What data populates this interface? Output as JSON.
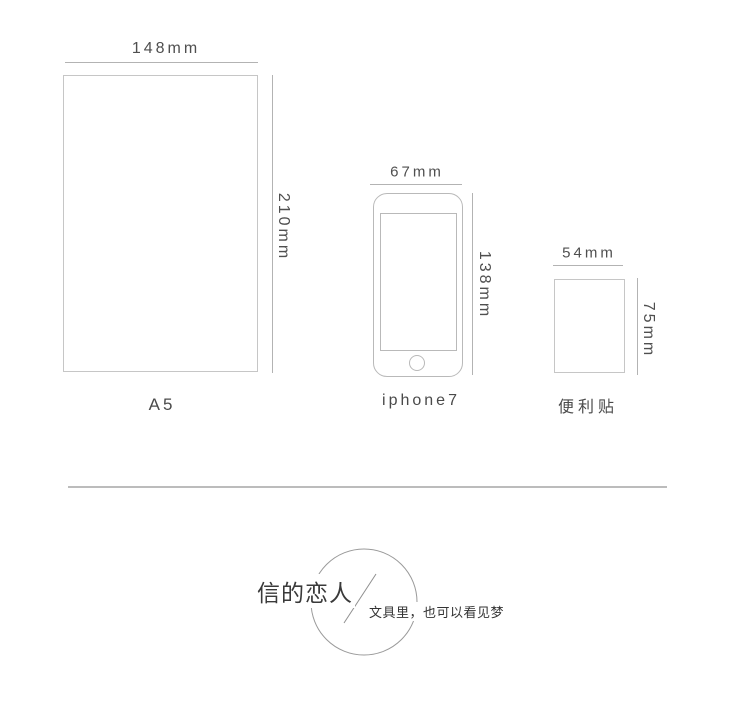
{
  "comparison": {
    "items": [
      {
        "name": "A5 paper",
        "label": "A5",
        "width": "148mm",
        "height": "210mm"
      },
      {
        "name": "iPhone 7",
        "label": "iphone7",
        "width": "67mm",
        "height": "138mm"
      },
      {
        "name": "sticky note",
        "label": "便利贴",
        "width": "54mm",
        "height": "75mm"
      }
    ]
  },
  "brand": {
    "name": "信的恋人",
    "tagline": "文具里，也可以看见梦"
  },
  "colors": {
    "background": "#ffffff",
    "outline": "#c6c6c6",
    "dimension_line": "#b3b3b3",
    "label_text": "#4f4f4f",
    "divider": "#bcbcbc",
    "logo_circle": "#9a9a9a",
    "brand_text": "#3a3a3a"
  }
}
